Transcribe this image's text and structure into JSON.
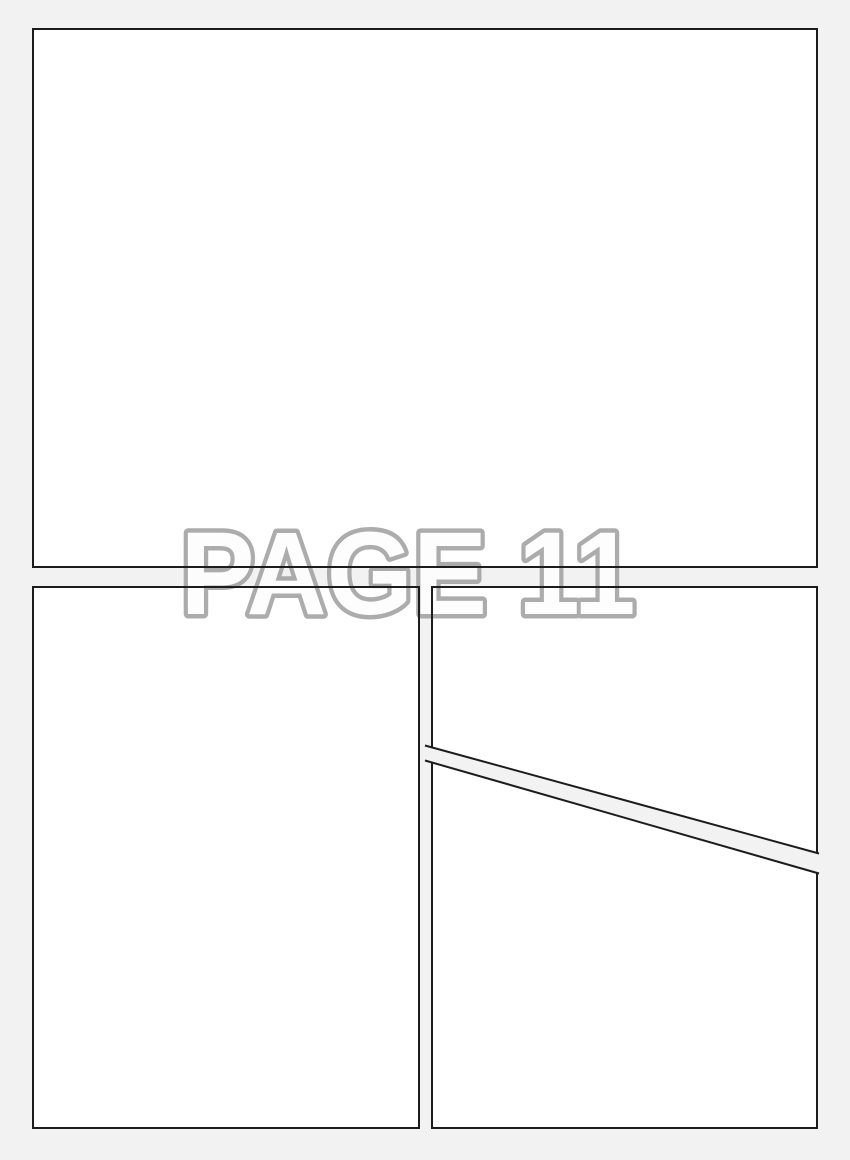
{
  "app": {
    "background_color": "#f2f2f2",
    "panel_fill_color": "#ffffff",
    "panel_border_color": "#1c1c1c",
    "page_label": {
      "text": "PAGE 11",
      "fill_color": "#fdfdfd",
      "outline_color": "#a6a6a6"
    },
    "panels": [
      {
        "name": "panel-1",
        "position": "top full-width"
      },
      {
        "name": "panel-2",
        "position": "bottom left column"
      },
      {
        "name": "panel-3",
        "position": "bottom right column, above diagonal gutter"
      },
      {
        "name": "panel-4",
        "position": "bottom right column, below diagonal gutter"
      }
    ]
  }
}
